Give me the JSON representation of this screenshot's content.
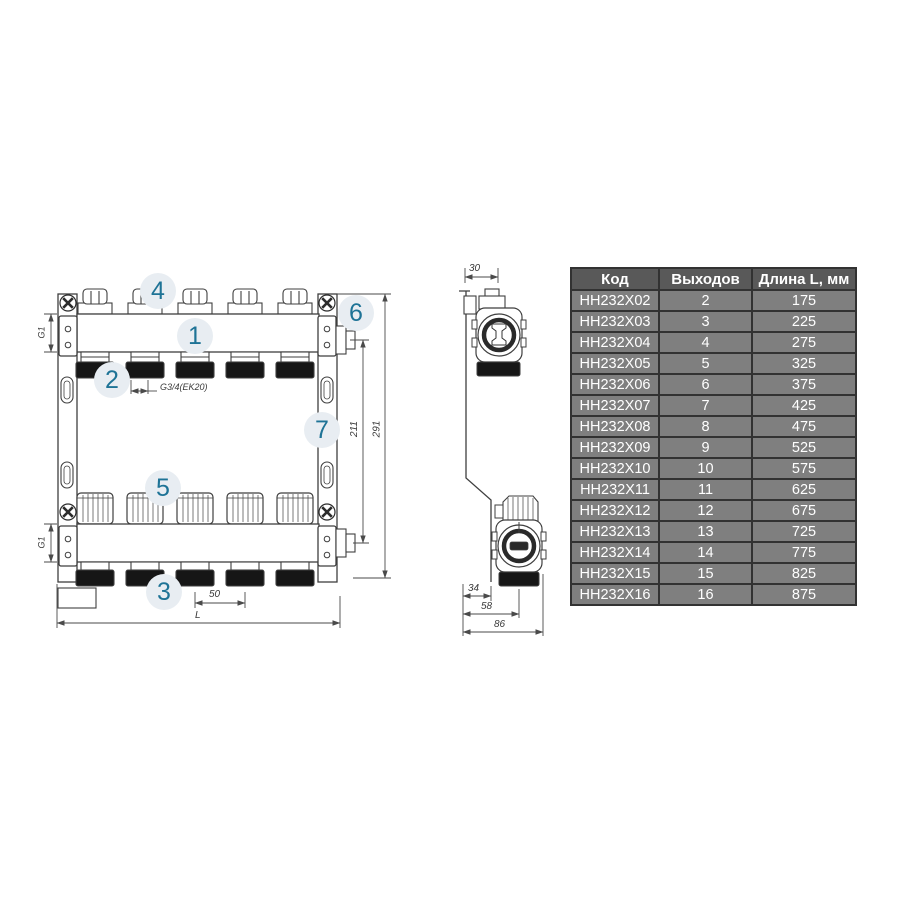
{
  "colors": {
    "line": "#3f3f3f",
    "accent_text": "#1e7396",
    "callout_bg": "#e8edf2",
    "table_header_bg": "#595959",
    "table_row_bg": "#7f7f7f",
    "table_border": "#323232",
    "table_text": "#ffffff"
  },
  "callouts": {
    "c1": "1",
    "c2": "2",
    "c3": "3",
    "c4": "4",
    "c5": "5",
    "c6": "6",
    "c7": "7"
  },
  "dimensions": {
    "g1_top": "G1",
    "g1_bottom": "G1",
    "g34": "G3/4(EK20)",
    "spacing": "50",
    "length": "L",
    "h_inner": "211",
    "h_outer": "291",
    "depth_top": "30",
    "d34": "34",
    "d58": "58",
    "d86": "86"
  },
  "table": {
    "headers": [
      "Код",
      "Выходов",
      "Длина L, мм"
    ],
    "rows": [
      {
        "code": "HH232X02",
        "outputs": "2",
        "length": "175"
      },
      {
        "code": "HH232X03",
        "outputs": "3",
        "length": "225"
      },
      {
        "code": "HH232X04",
        "outputs": "4",
        "length": "275"
      },
      {
        "code": "HH232X05",
        "outputs": "5",
        "length": "325"
      },
      {
        "code": "HH232X06",
        "outputs": "6",
        "length": "375"
      },
      {
        "code": "HH232X07",
        "outputs": "7",
        "length": "425"
      },
      {
        "code": "HH232X08",
        "outputs": "8",
        "length": "475"
      },
      {
        "code": "HH232X09",
        "outputs": "9",
        "length": "525"
      },
      {
        "code": "HH232X10",
        "outputs": "10",
        "length": "575"
      },
      {
        "code": "HH232X11",
        "outputs": "11",
        "length": "625"
      },
      {
        "code": "HH232X12",
        "outputs": "12",
        "length": "675"
      },
      {
        "code": "HH232X13",
        "outputs": "13",
        "length": "725"
      },
      {
        "code": "HH232X14",
        "outputs": "14",
        "length": "775"
      },
      {
        "code": "HH232X15",
        "outputs": "15",
        "length": "825"
      },
      {
        "code": "HH232X16",
        "outputs": "16",
        "length": "875"
      }
    ]
  }
}
